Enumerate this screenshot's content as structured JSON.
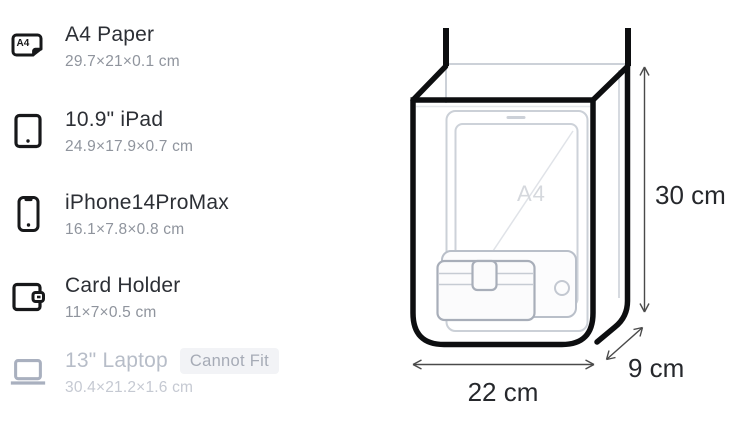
{
  "items": [
    {
      "name": "A4 Paper",
      "dimensions": "29.7×21×0.1 cm",
      "icon": "a4-paper-icon",
      "fits": true
    },
    {
      "name": "10.9\" iPad",
      "dimensions": "24.9×17.9×0.7 cm",
      "icon": "ipad-icon",
      "fits": true
    },
    {
      "name": "iPhone14ProMax",
      "dimensions": "16.1×7.8×0.8 cm",
      "icon": "iphone-icon",
      "fits": true
    },
    {
      "name": "Card Holder",
      "dimensions": "11×7×0.5 cm",
      "icon": "card-holder-icon",
      "fits": true
    },
    {
      "name": "13\" Laptop",
      "dimensions": "30.4×21.2×1.6 cm",
      "icon": "laptop-icon",
      "fits": false,
      "badge": "Cannot Fit"
    }
  ],
  "bag": {
    "height_label": "30 cm",
    "width_label": "22 cm",
    "depth_label": "9 cm",
    "inner_item_label": "A4"
  },
  "colors": {
    "text_primary": "#2c2f35",
    "text_secondary": "#8f949d",
    "muted": "#b7bdc8",
    "badge_bg": "#f2f3f6",
    "badge_text": "#a6abb6",
    "bag_outline": "#0d0e10",
    "interior_line": "#cbd0d7",
    "dimension_text": "#26282c"
  }
}
